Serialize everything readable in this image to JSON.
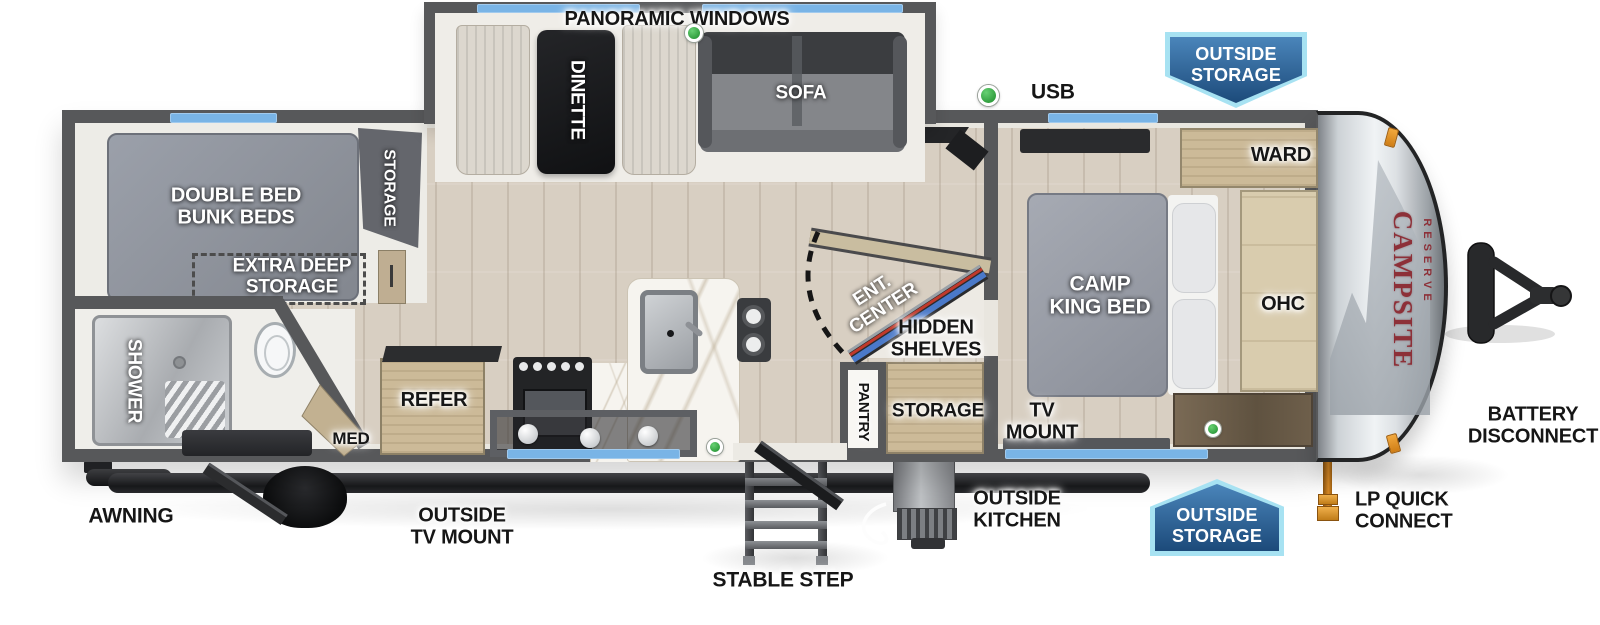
{
  "title": "Travel trailer floorplan",
  "brand": {
    "primary": "CAMPSITE",
    "secondary": "RESERVE"
  },
  "legend": {
    "usb": "USB"
  },
  "badges": {
    "top": {
      "line1": "OUTSIDE",
      "line2": "STORAGE"
    },
    "bottom": {
      "line1": "OUTSIDE",
      "line2": "STORAGE"
    }
  },
  "rooms": {
    "slideout": {
      "panoramic": "PANORAMIC WINDOWS",
      "dinette": "DINETTE",
      "sofa": "SOFA"
    },
    "bunk": {
      "bed_line1": "DOUBLE BED",
      "bed_line2": "BUNK BEDS",
      "storage": "STORAGE",
      "extra_line1": "EXTRA DEEP",
      "extra_line2": "STORAGE"
    },
    "bath": {
      "shower": "SHOWER",
      "med": "MED"
    },
    "kitchen": {
      "refer": "REFER"
    },
    "mid": {
      "ent_line1": "ENT.",
      "ent_line2": "CENTER",
      "hidden_line1": "HIDDEN",
      "hidden_line2": "SHELVES",
      "pantry": "PANTRY",
      "storage": "STORAGE"
    },
    "bedroom": {
      "bed_line1": "CAMP",
      "bed_line2": "KING BED",
      "ward": "WARD",
      "ohc": "OHC",
      "tv_line1": "TV",
      "tv_line2": "MOUNT"
    }
  },
  "exterior": {
    "awning": "AWNING",
    "outside_tv_line1": "OUTSIDE",
    "outside_tv_line2": "TV MOUNT",
    "stable_step": "STABLE STEP",
    "outside_kitchen_line1": "OUTSIDE",
    "outside_kitchen_line2": "KITCHEN",
    "lp_line1": "LP QUICK",
    "lp_line2": "CONNECT",
    "battery_line1": "BATTERY",
    "battery_line2": "DISCONNECT"
  },
  "colors": {
    "wall": "#57585a",
    "window": "#79b4e6",
    "usb_dot": "#3fae4a",
    "badge_dark": "#1c4a7a",
    "badge_light": "#4a85ba",
    "badge_border": "#a7e2f2",
    "brand_red": "#8d3038",
    "lp_orange": "#d98a26",
    "floor": "#d8cfc2"
  }
}
